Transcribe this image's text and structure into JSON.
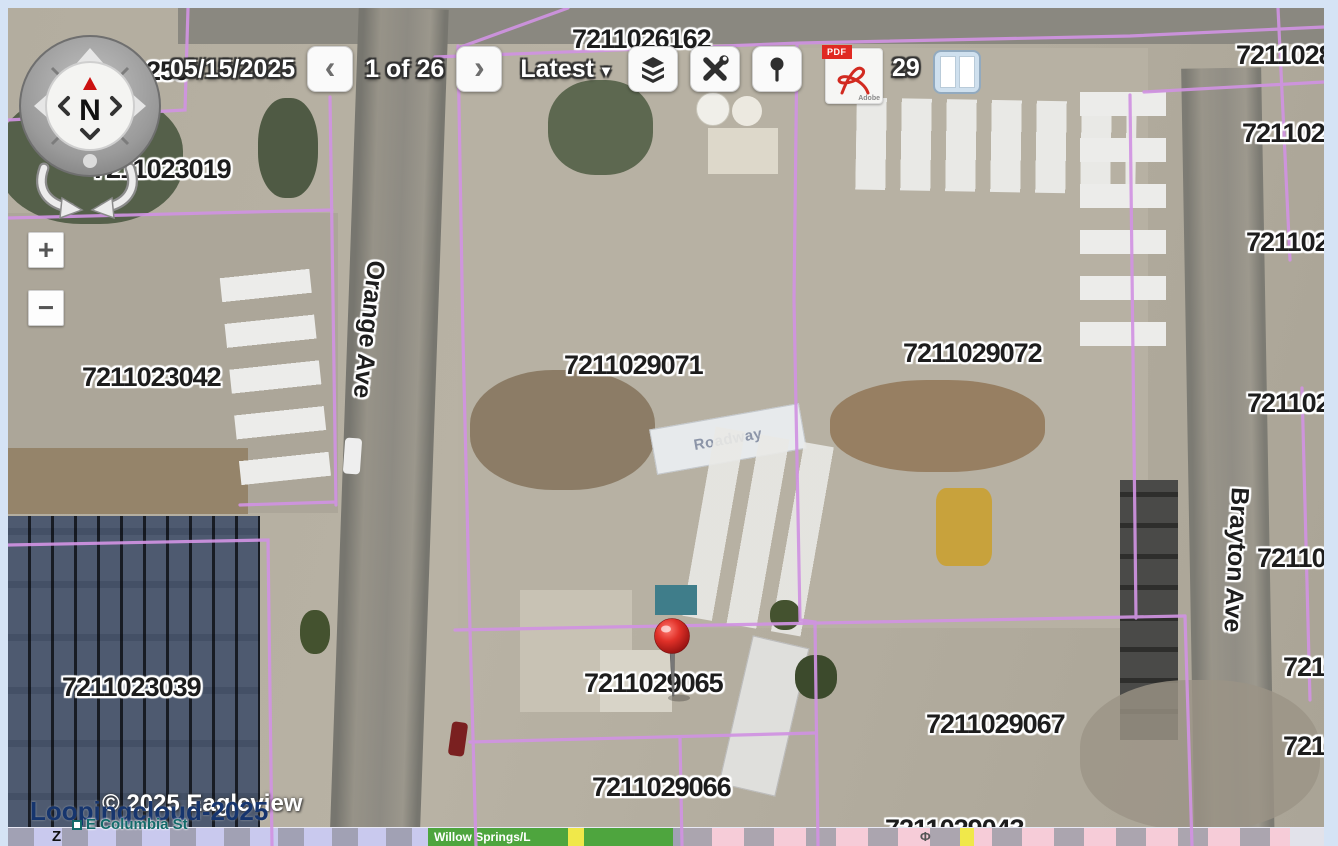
{
  "toolbar": {
    "date": "05/15/2025",
    "prev": "‹",
    "page_indicator": "1 of 26",
    "next": "›",
    "version_dropdown": {
      "label": "Latest",
      "caret": "▾"
    },
    "pdf_icon": {
      "badge": "PDF",
      "brand": "Adobe"
    },
    "obscured_parcel_fragments": {
      "left": "1",
      "right": "29"
    }
  },
  "compass": {
    "north": "N"
  },
  "zoom_controls": {
    "zoom_in": "+",
    "zoom_out": "−"
  },
  "parcel_labels": [
    {
      "text": "7211026162"
    },
    {
      "text": "7211028"
    },
    {
      "text": "721102"
    },
    {
      "text": "721102"
    },
    {
      "text": "7211023019"
    },
    {
      "text": "7211023042"
    },
    {
      "text": "7211029071"
    },
    {
      "text": "7211029072"
    },
    {
      "text": "7211023039"
    },
    {
      "text": "7211029065"
    },
    {
      "text": "7211029066"
    },
    {
      "text": "7211029067"
    },
    {
      "text": "721102"
    },
    {
      "text": "72110"
    },
    {
      "text": "72110"
    },
    {
      "text": "72110"
    },
    {
      "text": "7211029043"
    },
    {
      "text": "250"
    }
  ],
  "street_labels": {
    "orange_ave": "Orange Ave",
    "brayton_ave": "Brayton Ave"
  },
  "aerial_features": {
    "truck_brand": "Roadway"
  },
  "watermark": {
    "brand": "Loopingcloud-2025",
    "copyright": "© 2025 Eagleview"
  },
  "mini_map": {
    "street_label": "E Columbia St",
    "edge_label": "Z",
    "area_label": "Willow Springs/L",
    "poi_symbol": "Φ"
  },
  "colors": {
    "parcel_line": "#d093e2",
    "pin": "#d42a20",
    "page_margin": "#d5e3f5",
    "watermark_blue": "#16356e",
    "mini_map_lavender": "#c9c9ee",
    "mini_map_pink": "#f6ccd8",
    "mini_map_green": "#4ea53e",
    "mini_map_road_yellow": "#f0e84a"
  }
}
